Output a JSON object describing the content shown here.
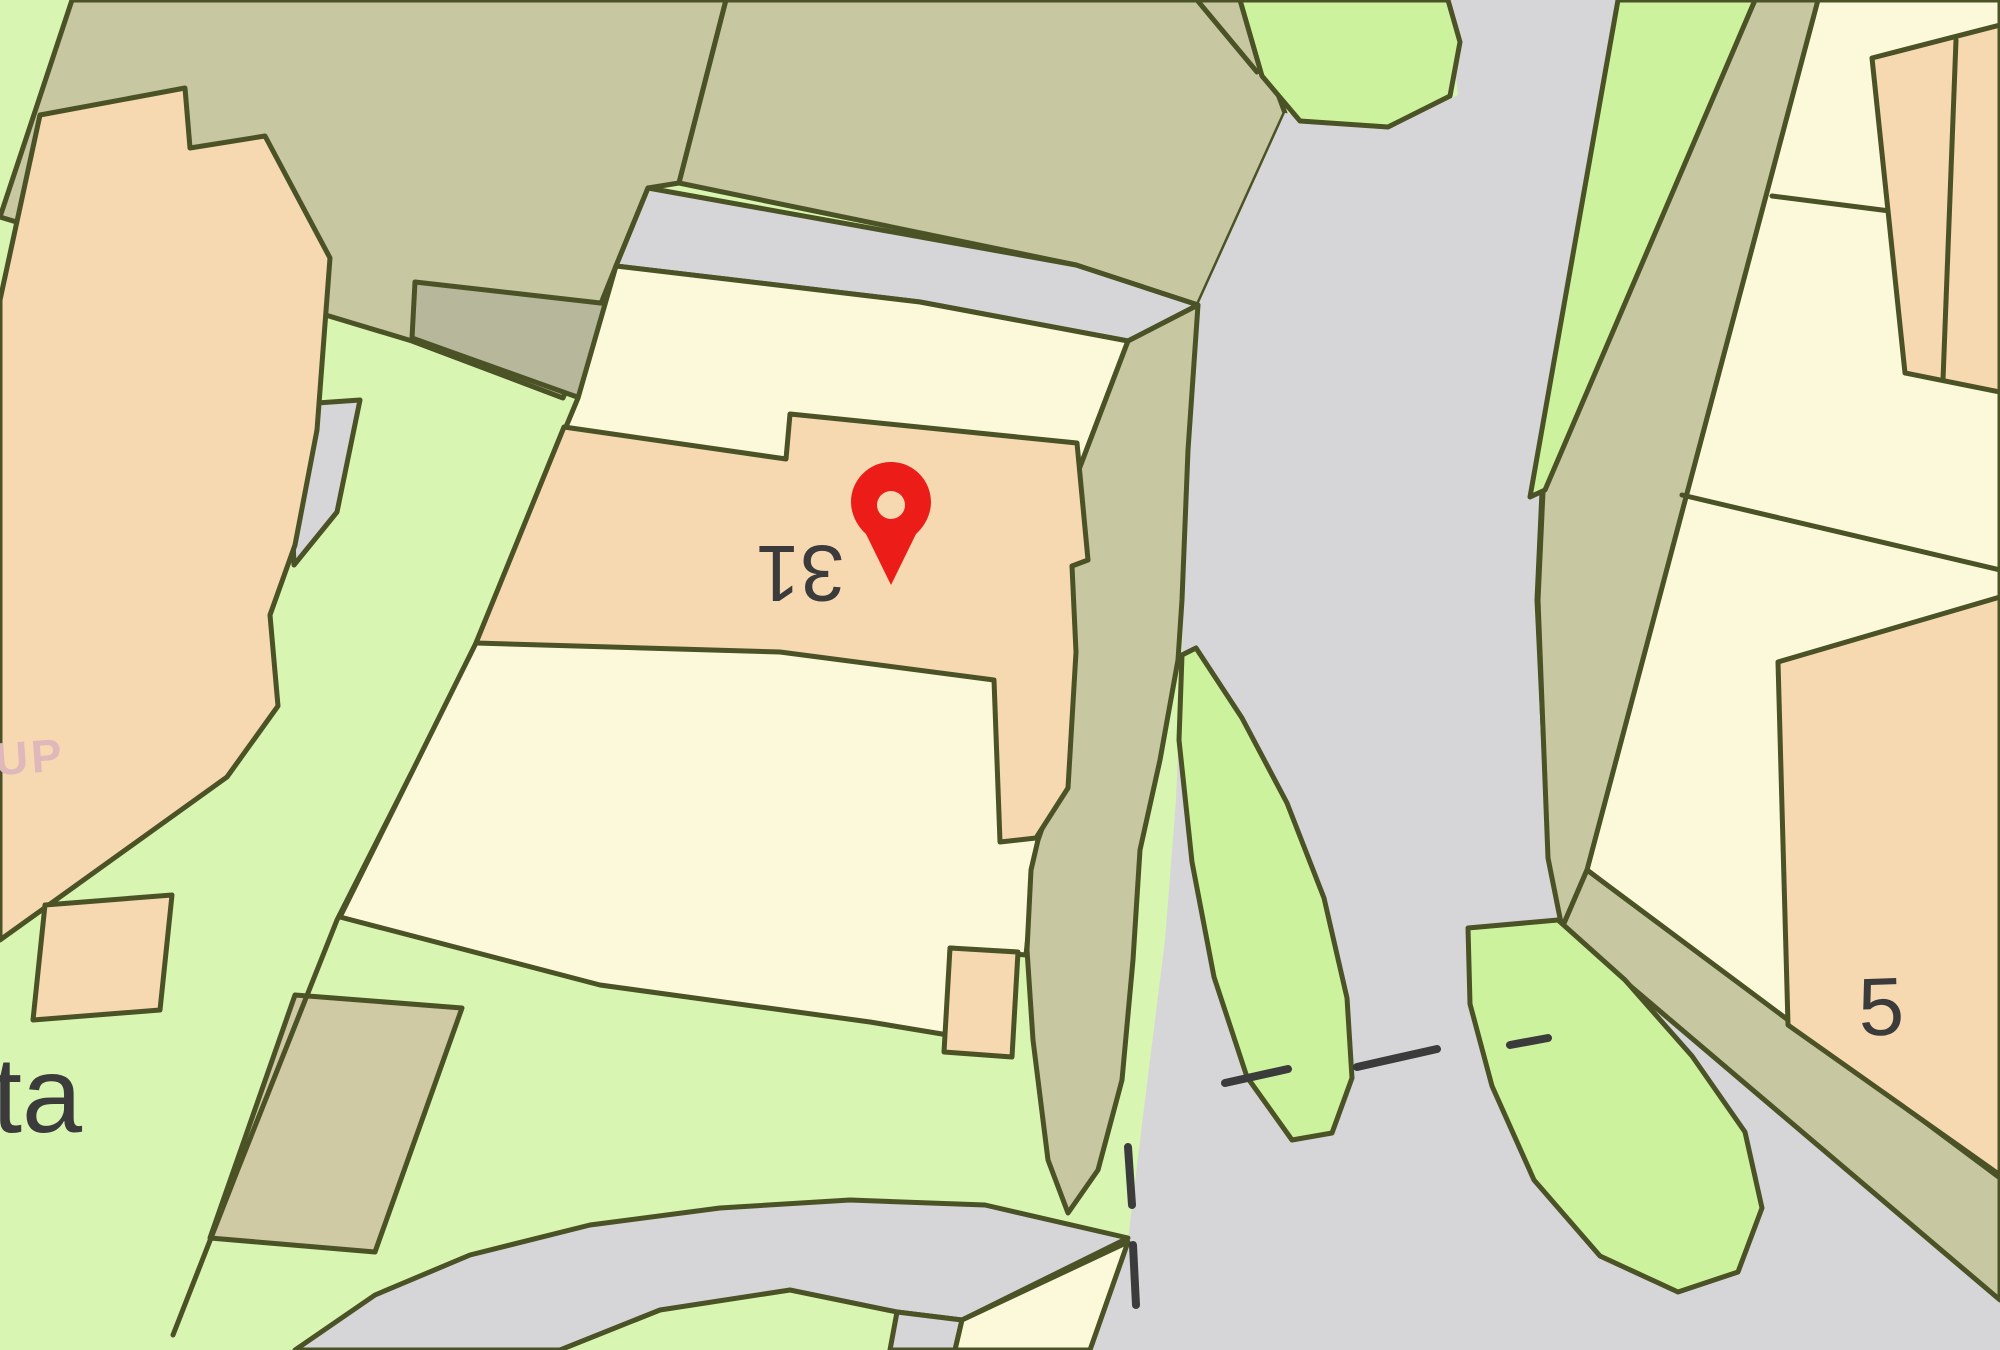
{
  "map": {
    "type": "property-location-map",
    "labels": {
      "house_number": "31",
      "neighbor_house_number": "5",
      "street_fragment": "ta",
      "faded_fragment": "UP"
    },
    "marker": {
      "name": "location-pin",
      "shape": "map-pin"
    }
  },
  "colors": {
    "background_green": "#d8f5b2",
    "bright_green": "#cdf29d",
    "olive": "#c7c7a1",
    "olive_dark": "#b7b89b",
    "khaki_parcel": "#cfc9a4",
    "peach_building": "#f6d8b1",
    "pale_yellow": "#fbf9d9",
    "road_gray": "#d6d6d8",
    "boundary_line": "#4b5226",
    "dash_line": "#3b3b3b",
    "label_text": "#3b3b3b",
    "faded_text": "#dfb8bb",
    "pin_red": "#ec1d18",
    "pin_hole": "#f6d8b1"
  }
}
